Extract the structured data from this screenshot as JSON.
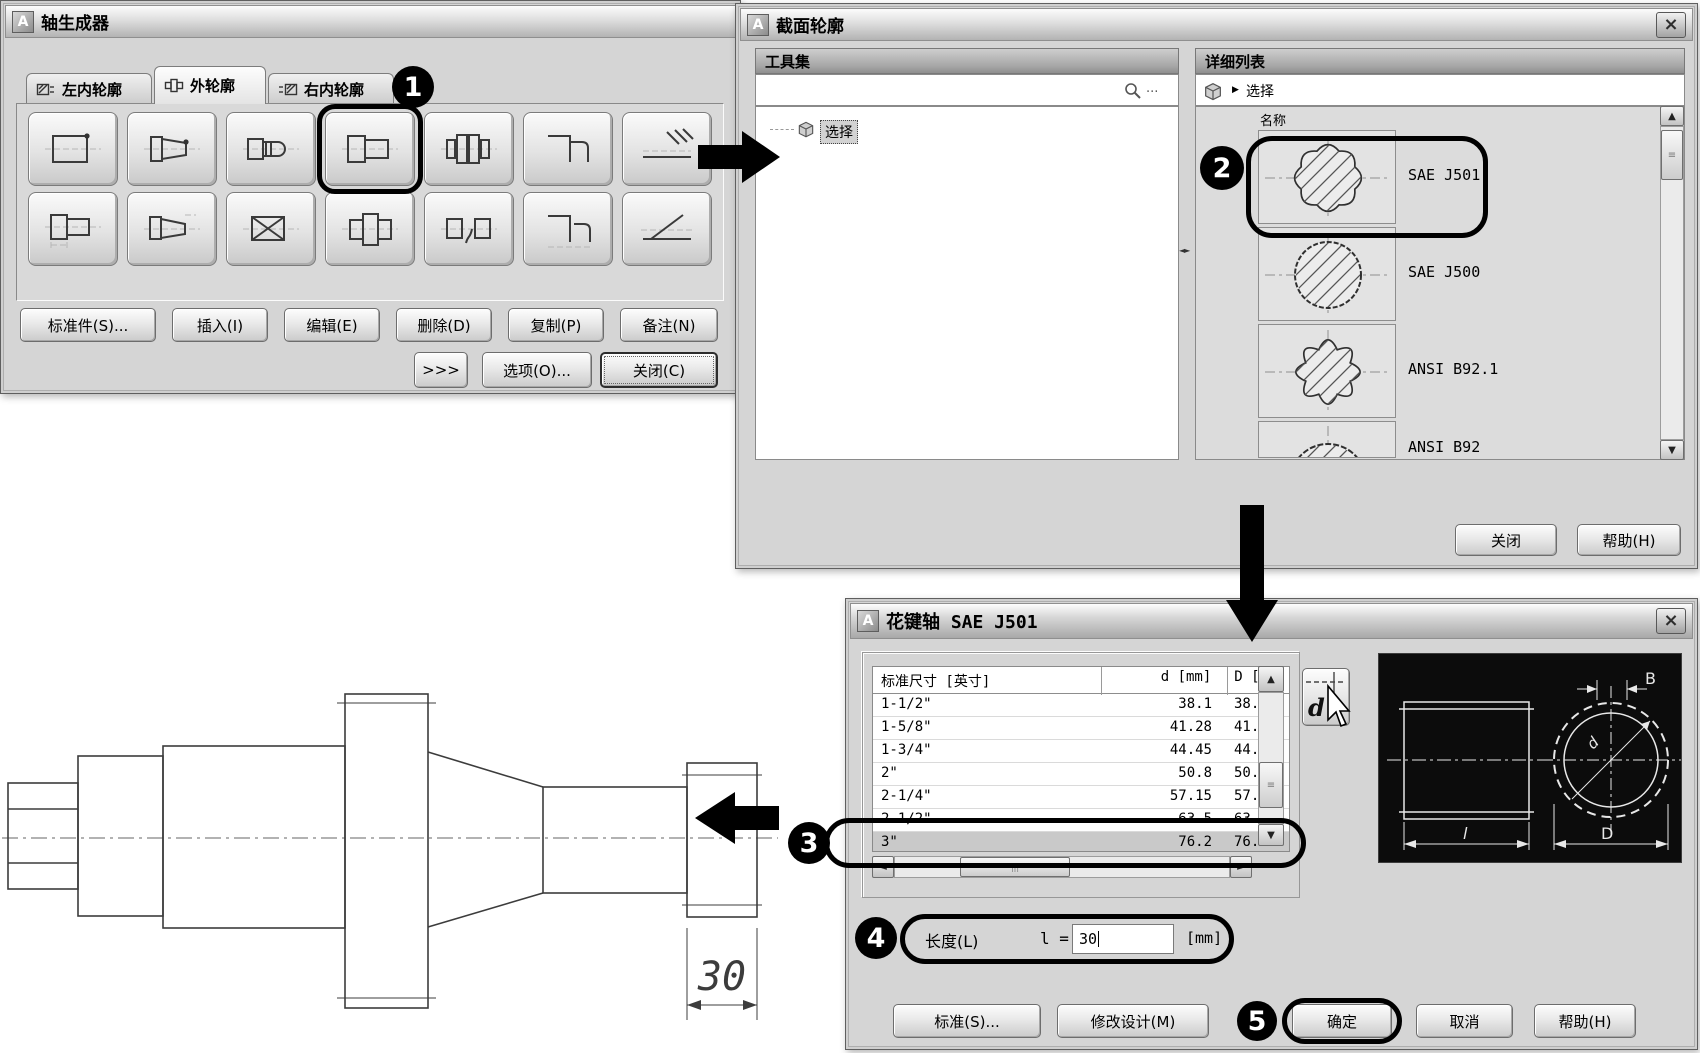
{
  "callouts": {
    "c1": "1",
    "c2": "2",
    "c3": "3",
    "c4": "4",
    "c5": "5"
  },
  "shaft_builder": {
    "title": "轴生成器",
    "tabs": [
      {
        "label": "左内轮廓"
      },
      {
        "label": "外轮廓"
      },
      {
        "label": "右内轮廓"
      }
    ],
    "action_buttons": [
      "标准件(S)...",
      "插入(I)",
      "编辑(E)",
      "删除(D)",
      "复制(P)",
      "备注(N)"
    ],
    "more_button": ">>>",
    "options_button": "选项(O)...",
    "close_button": "关闭(C)"
  },
  "section_profile": {
    "title": "截面轮廓",
    "toolset_header": "工具集",
    "search_dots": "...",
    "tree_item": "选择",
    "detail_header": "详细列表",
    "breadcrumb_arrow": "▶",
    "breadcrumb_item": "选择",
    "name_column": "名称",
    "items": [
      {
        "name": "SAE J501"
      },
      {
        "name": "SAE J500"
      },
      {
        "name": "ANSI B92.1"
      },
      {
        "name": "ANSI B92"
      }
    ],
    "close_button": "关闭",
    "help_button": "帮助(H)"
  },
  "spline_dialog": {
    "title": "花键轴 SAE J501",
    "table": {
      "headers": [
        "标准尺寸 [英寸]",
        "d [mm]",
        "D [m"
      ],
      "rows": [
        {
          "size": "1-1/2\"",
          "d": "38.1",
          "D": "38.0"
        },
        {
          "size": "1-5/8\"",
          "d": "41.28",
          "D": "41.2"
        },
        {
          "size": "1-3/4\"",
          "d": "44.45",
          "D": "44.4"
        },
        {
          "size": "2\"",
          "d": "50.8",
          "D": "50.7"
        },
        {
          "size": "2-1/4\"",
          "d": "57.15",
          "D": "57.1"
        },
        {
          "size": "2-1/2\"",
          "d": "63.5",
          "D": "63.4"
        },
        {
          "size": "3\"",
          "d": "76.2",
          "D": "76.1"
        }
      ]
    },
    "d_button_label": "d",
    "preview": {
      "label_b": "B",
      "label_d": "d",
      "label_l": "l",
      "label_big_d": "D"
    },
    "length_label": "长度(L)",
    "length_var": "l =",
    "length_value": "30",
    "length_unit": "[mm]",
    "buttons": {
      "standard": "标准(S)...",
      "modify": "修改设计(M)",
      "ok": "确定",
      "cancel": "取消",
      "help": "帮助(H)"
    }
  },
  "drawing": {
    "dimension": "30"
  }
}
